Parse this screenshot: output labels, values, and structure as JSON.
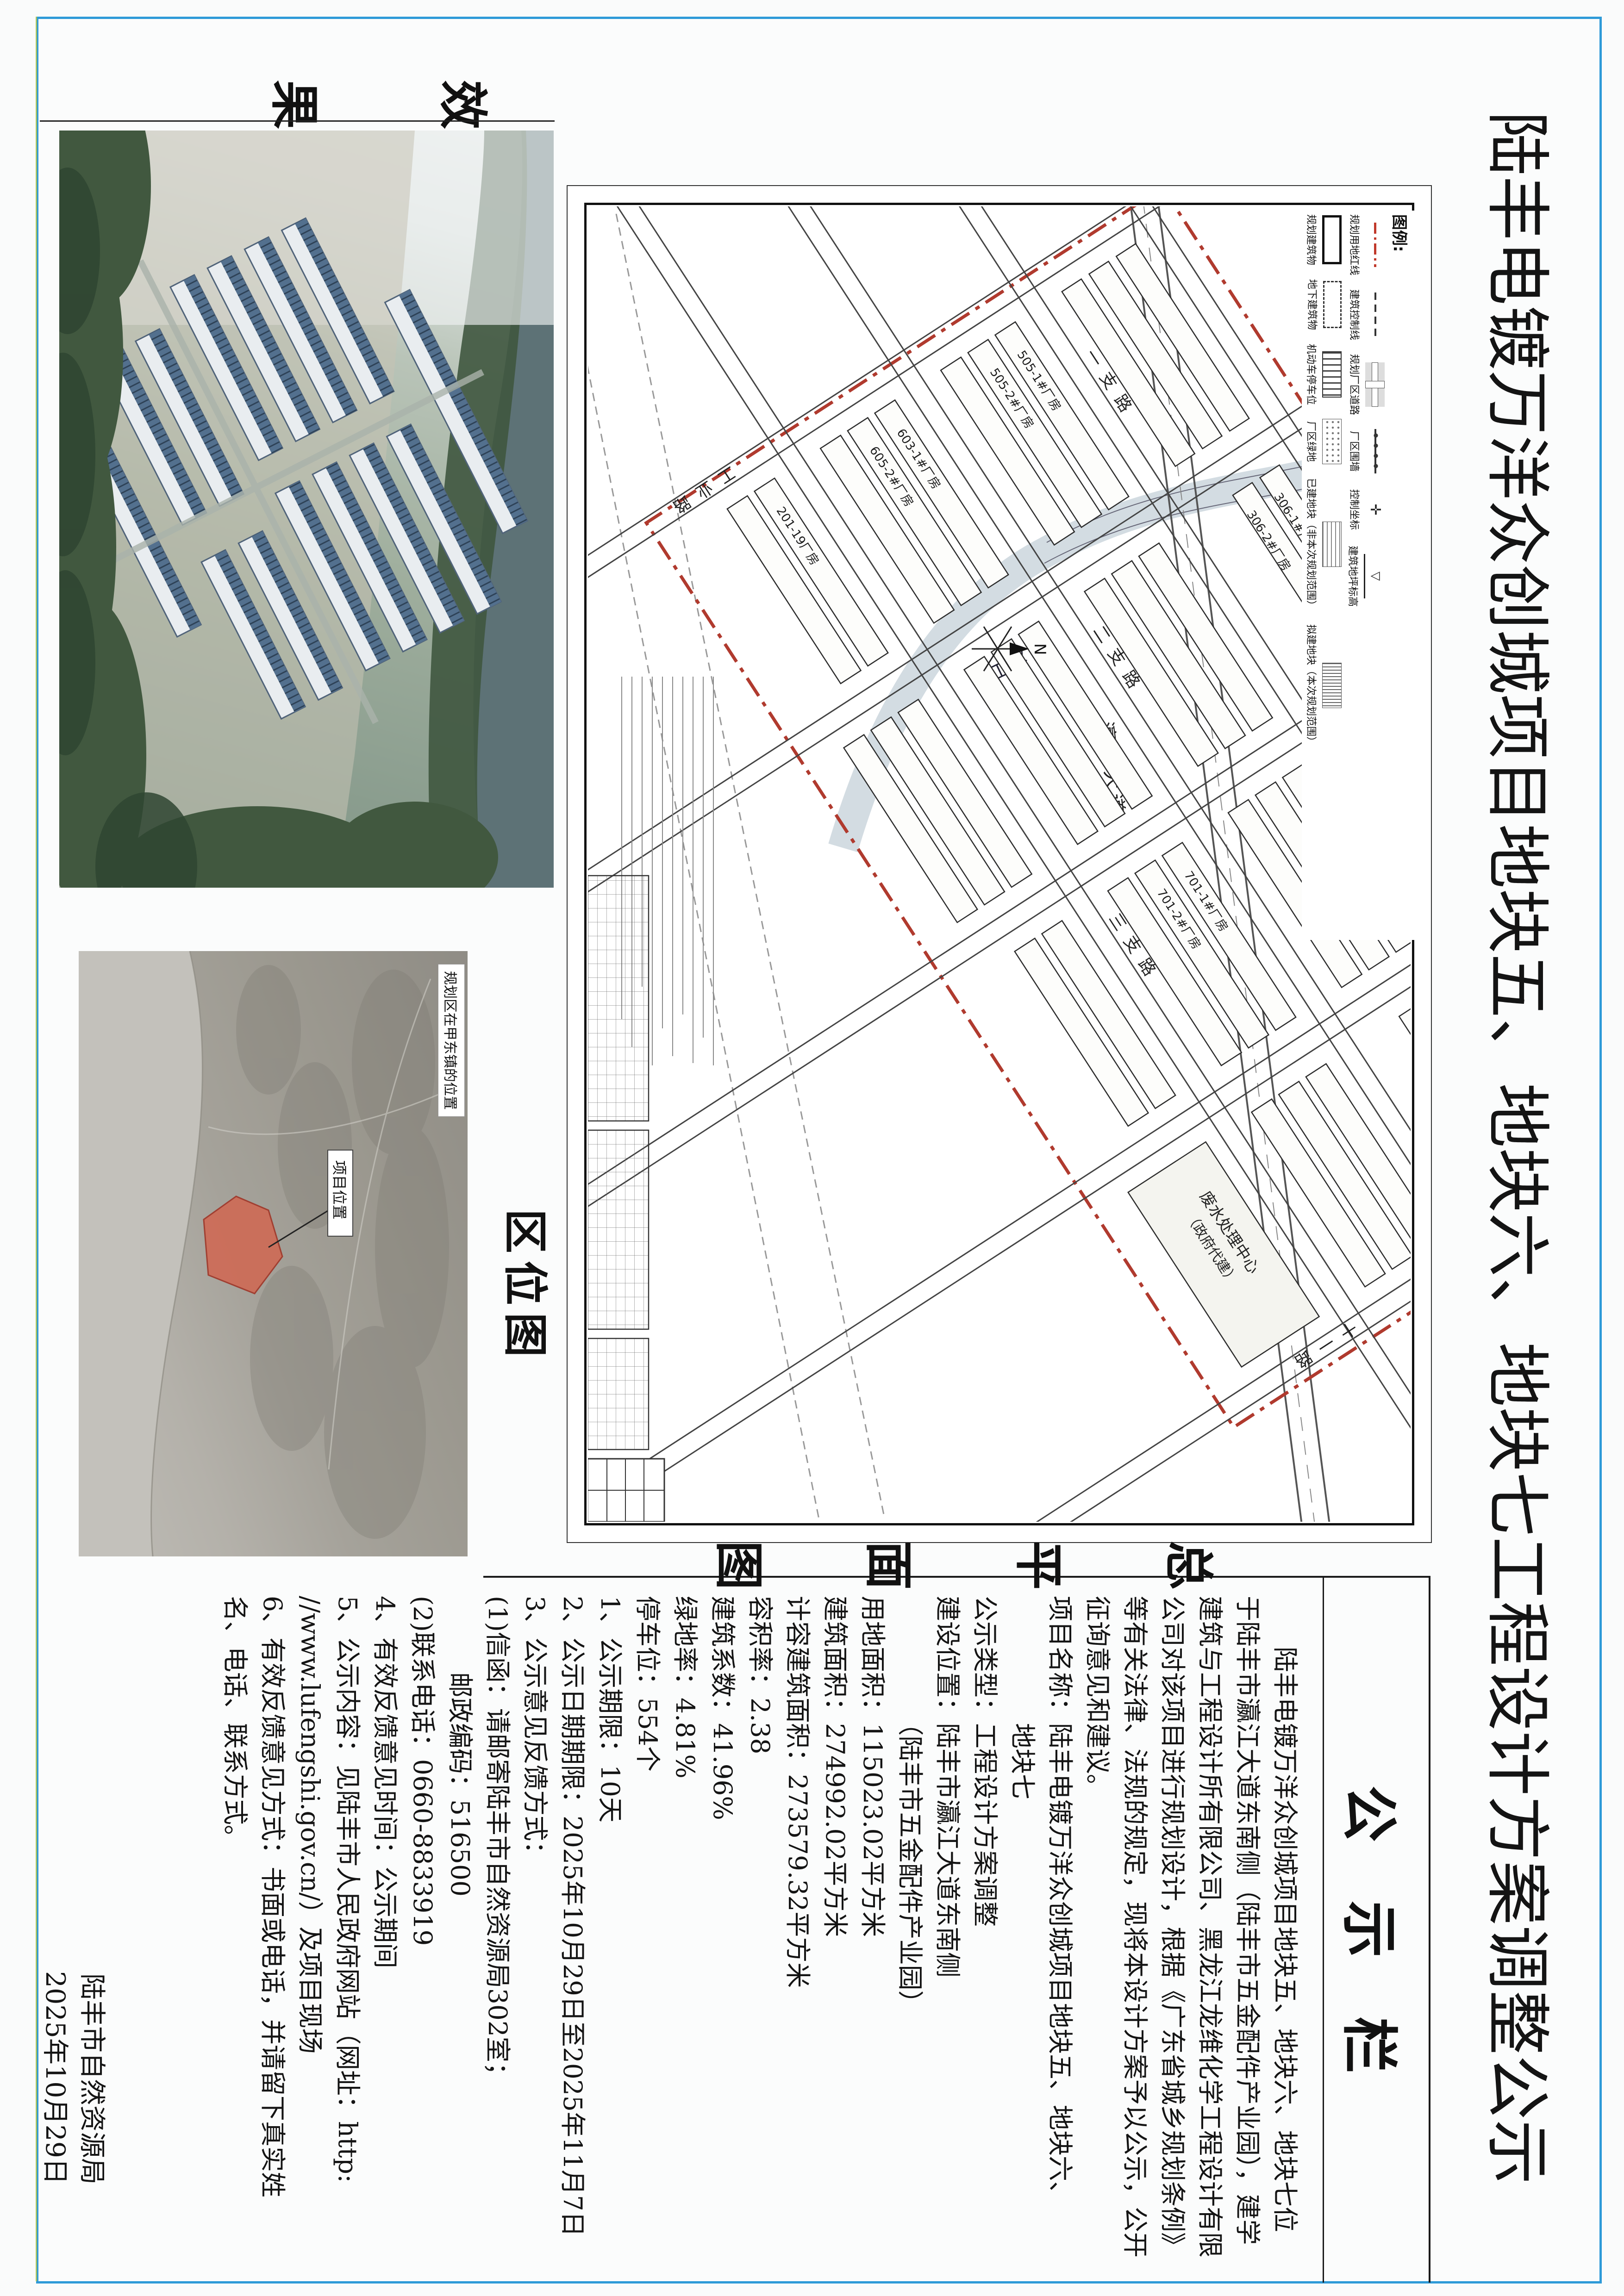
{
  "title": "陆丰电镀万洋众创城项目地块五、地块六、地块七工程设计方案调整公示",
  "captions": {
    "site_plan": "总平面图",
    "location_map": "区位图",
    "rendering": "效果图"
  },
  "notice": {
    "header": "公示栏",
    "paragraph": [
      "　　陆丰电镀万洋众创城项目地块五、地块六、地块七位",
      "于陆丰市瀛江大道东南侧（陆丰市五金配件产业园），建学",
      "建筑与工程设计所有限公司、黑龙江龙维化学工程设计有限",
      "公司对该项目进行规划设计，根据《广东省城乡规划条例》",
      "等有关法律、法规的规定，现将本设计方案予以公示，公开",
      "征询意见和建议。"
    ],
    "details": [
      "项目名称：陆丰电镀万洋众创城项目地块五、地块六、",
      "　　　　　地块七",
      "公示类型：工程设计方案调整",
      "建设位置：陆丰市瀛江大道东南侧",
      "　　　　　（陆丰市五金配件产业园）",
      "用地面积：115023.02平方米",
      "建筑面积：274992.02平方米",
      "计容建筑面积：273579.32平方米",
      "容积率：2.38",
      "建筑系数：41.96%",
      "绿地率：4.81%",
      "停车位：554个"
    ],
    "items": [
      "1、公示期限：10天",
      "2、公示日期期限：2025年10月29日至2025年11月7日",
      "3、公示意见反馈方式：",
      "(1)信函：请邮寄陆丰市自然资源局302室；",
      "　　　邮政编码：516500",
      "(2)联系电话：0660-8833919",
      "4、有效反馈意见时间：公示期间",
      "5、公示内容：见陆丰市人民政府网站（网址：http:",
      "//www.lufengshi.gov.cn/）及项目现场",
      "6、有效反馈意见方式：书面或电话，并请留下真实姓",
      "名、电话、联系方式。"
    ],
    "signature": {
      "org": "陆丰市自然资源局",
      "date": "2025年10月29日"
    }
  },
  "plan": {
    "legend": {
      "title": "图例:",
      "row1": [
        "规划用地红线",
        "建筑控制线",
        "规划厂区道路",
        "厂区围墙",
        "控制坐标",
        "建筑地坪标高"
      ],
      "row2": [
        "规划建筑物",
        "地下建筑物",
        "机动车停车位",
        "厂区绿地",
        "已建地块（非本次规划范围）",
        "拟建地块（本次规划范围）"
      ],
      "coord_glyph": "✛",
      "level_glyph": "▽"
    },
    "roads": [
      "瀛江大道",
      "一支路",
      "二支路",
      "三支路",
      "一支路",
      "工业路",
      "十一路"
    ],
    "river": "瀛江",
    "north": "N",
    "buildings": [
      "306-1#厂房",
      "306-2#厂房",
      "505-1#厂房",
      "505-2#厂房",
      "603-1#厂房",
      "605-2#厂房",
      "701-1#厂房",
      "701-2#厂房",
      "201-19厂房"
    ],
    "facility": [
      "废水处理中心",
      "（政府代建）"
    ]
  },
  "location_map": {
    "note": "规划区在甲东镇的位置",
    "marker": "项目位置"
  }
}
